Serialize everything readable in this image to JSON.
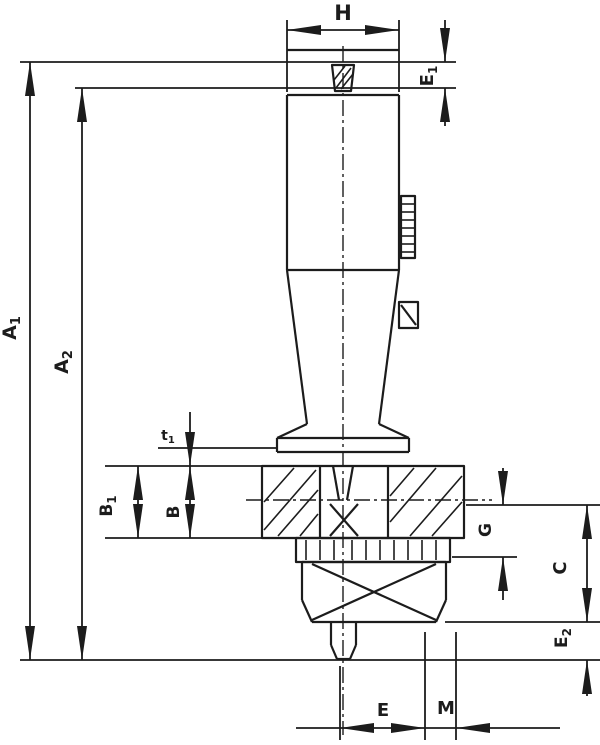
{
  "drawing": {
    "kind": "technical-dimension-drawing",
    "colors": {
      "ink": "#1c1c1c",
      "background": "#ffffff"
    },
    "dims": {
      "h": {
        "main": "H",
        "sub": ""
      },
      "e1": {
        "main": "E",
        "sub": "1"
      },
      "a1": {
        "main": "A",
        "sub": "1"
      },
      "a2": {
        "main": "A",
        "sub": "2"
      },
      "t1": {
        "main": "t",
        "sub": "1"
      },
      "b1": {
        "main": "B",
        "sub": "1"
      },
      "b": {
        "main": "B",
        "sub": ""
      },
      "g": {
        "main": "G",
        "sub": ""
      },
      "c": {
        "main": "C",
        "sub": ""
      },
      "e2": {
        "main": "E",
        "sub": "2"
      },
      "e": {
        "main": "E",
        "sub": ""
      },
      "m": {
        "main": "M",
        "sub": ""
      }
    }
  }
}
